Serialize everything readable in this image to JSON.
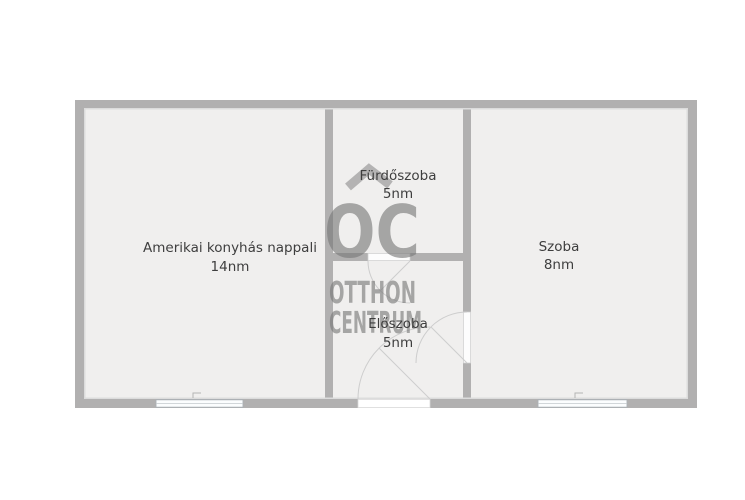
{
  "watermark": {
    "logo": "OC",
    "brand_line1": "OTTHON",
    "brand_line2": "CENTRUM"
  },
  "rooms": [
    {
      "name": "Amerikai konyhás nappali",
      "area": "14nm"
    },
    {
      "name": "Fürdőszoba",
      "area": "5nm"
    },
    {
      "name": "Előszoba",
      "area": "5nm"
    },
    {
      "name": "Szoba",
      "area": "8nm"
    }
  ],
  "colors": {
    "wall": "#b1b0b0",
    "floor": "#f0efee",
    "window_fill": "#fbfdfe",
    "door_arc": "#cdcdcd",
    "watermark": "#787878",
    "label_text": "#3e3e3e"
  }
}
